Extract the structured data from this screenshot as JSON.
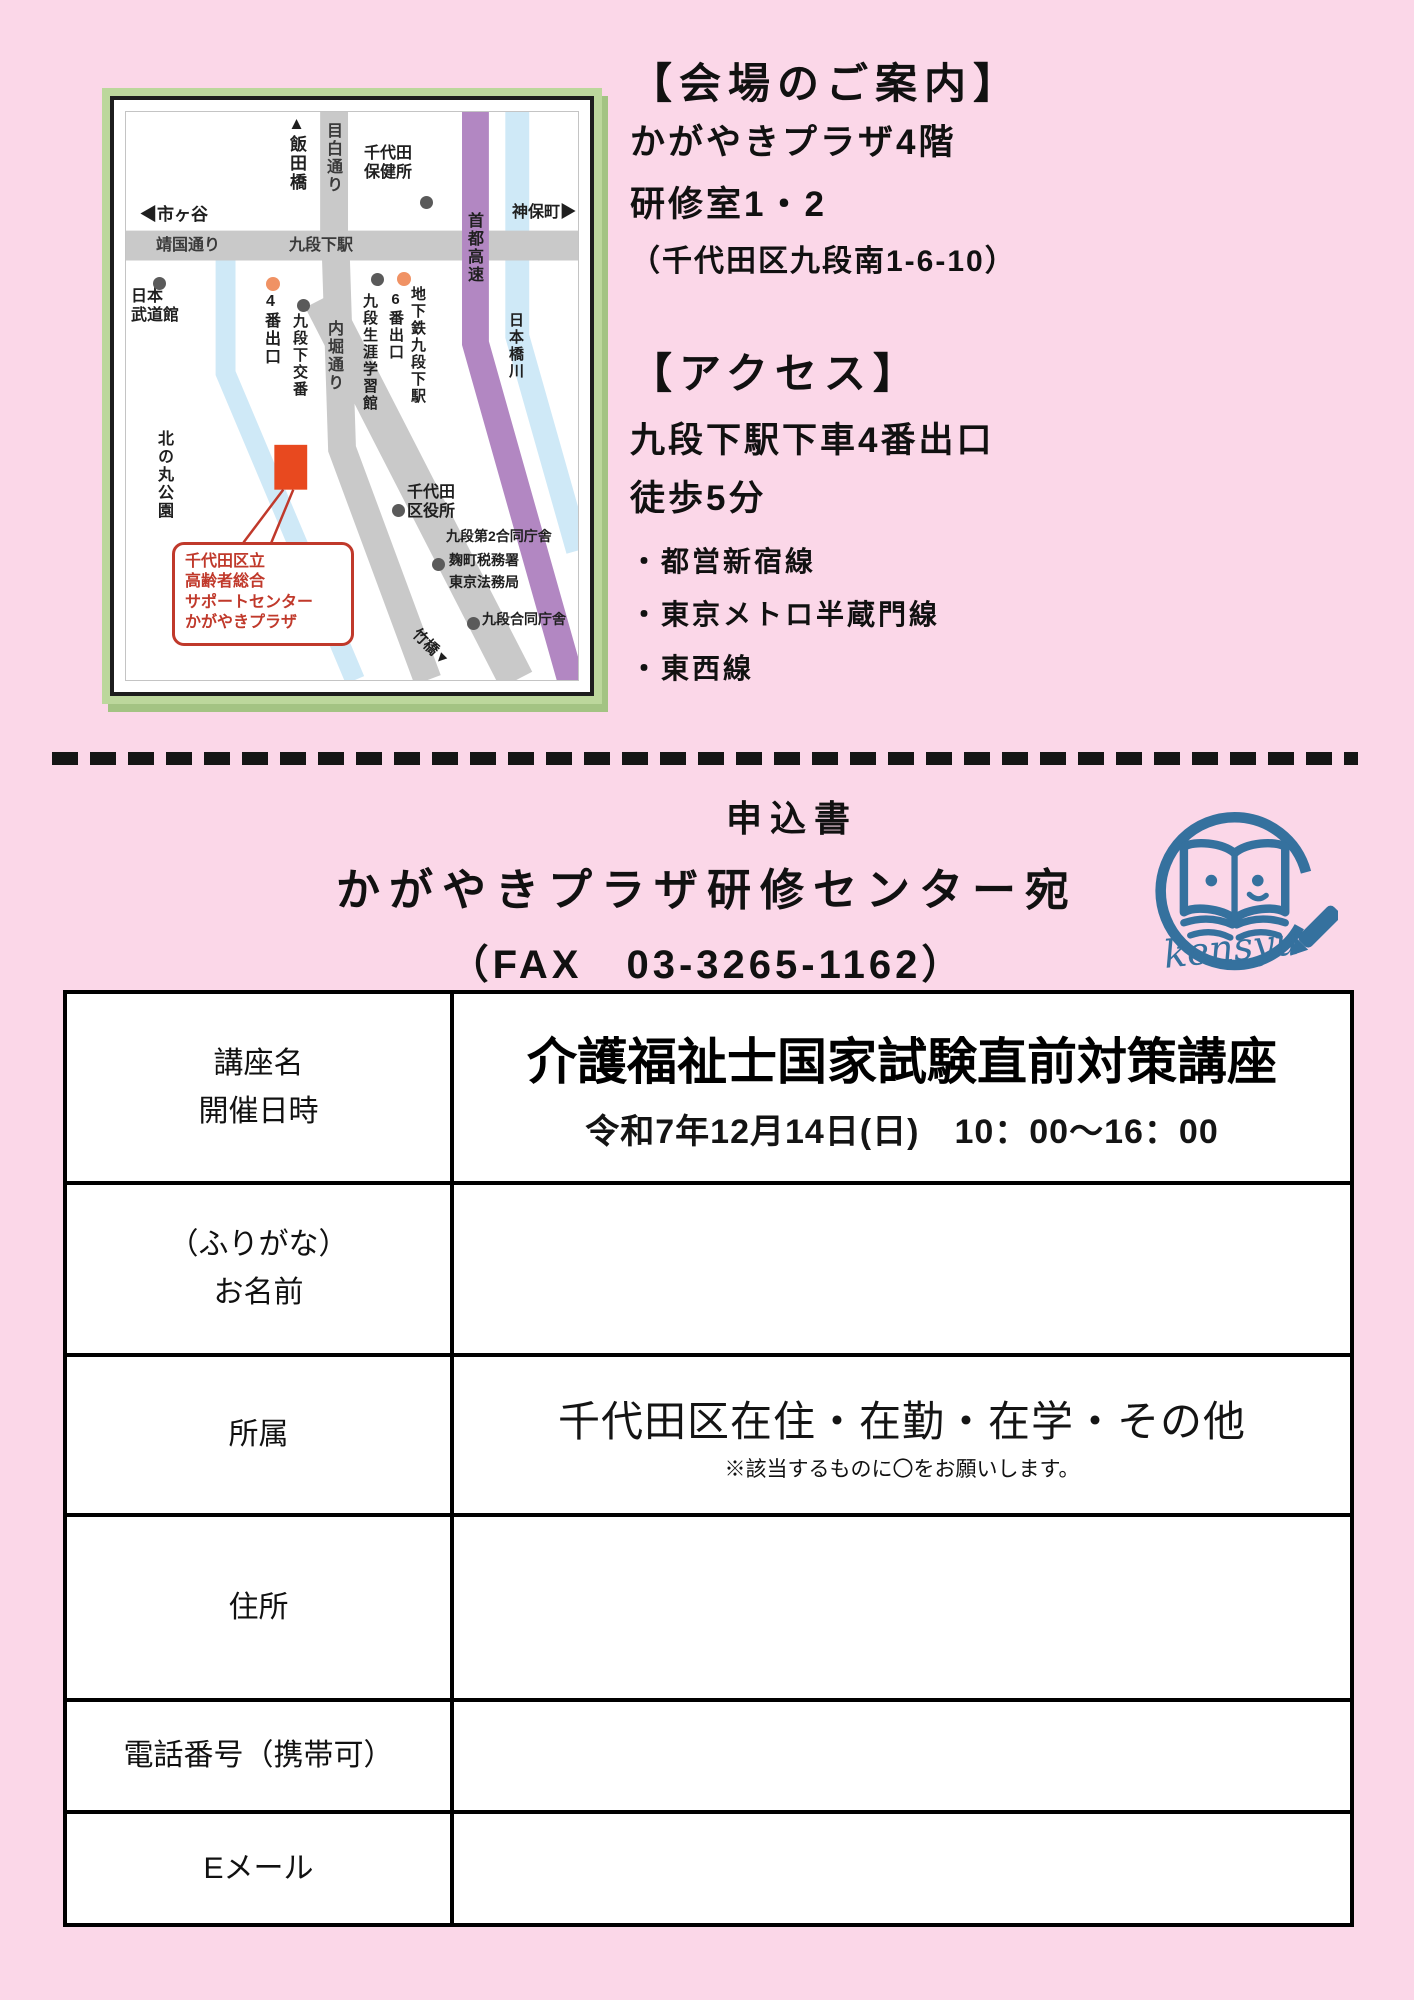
{
  "colors": {
    "page_bg": "#fbd7e8",
    "map_frame_green": "#bcd79c",
    "road_gray": "#c9c9c9",
    "expressway_purple": "#b287c2",
    "river_blue": "#cfe9f7",
    "venue_marker_orange": "#e8491f",
    "callout_red": "#c0392b",
    "exit_dot_orange": "#f09264",
    "logo_blue": "#35719e"
  },
  "map": {
    "iidabashi": "▲飯田橋",
    "mejiro_dori": "目白通り",
    "chiyoda_hokenjo": "千代田\n保健所",
    "ichigaya": "◀市ヶ谷",
    "yasukuni_dori": "靖国通り",
    "kudanshita_station": "九段下駅",
    "jimbocho": "神保町▶",
    "shuto_kosoku": "首都高速",
    "nihonbashi_gawa": "日本橋川",
    "nihon_budokan": "日本\n武道館",
    "exit4": "4番出口",
    "kudanshita_koban": "九段下交番",
    "uchibori_dori": "内堀通り",
    "kudan_shogai_gakushukan": "九段生涯学習館",
    "exit6": "6番出口",
    "chikatetsu_kudanshita": "地下鉄九段下駅",
    "kitanomaru_koen": "北の丸公園",
    "chiyoda_kuyakusho": "千代田\n区役所",
    "kudan_dai2_godochosha": "九段第2合同庁舎",
    "kojimachi_zeimusho": "麹町税務署",
    "tokyo_homukyoku": "東京法務局",
    "kudan_godochosha": "九段合同庁舎",
    "takebashi": "竹橋▼",
    "venue_callout": "千代田区立\n高齢者総合\nサポートセンター\nかがやきプラザ"
  },
  "venue": {
    "heading": "【会場のご案内】",
    "line1": "かがやきプラザ4階",
    "line2": "研修室1・2",
    "address": "（千代田区九段南1-6-10）"
  },
  "access": {
    "heading": "【アクセス】",
    "line1": "九段下駅下車4番出口",
    "line2": "徒歩5分",
    "bullets": [
      "・都営新宿線",
      "・東京メトロ半蔵門線",
      "・東西線"
    ]
  },
  "form_header": {
    "title": "申込書",
    "recipient": "かがやきプラザ研修センター宛",
    "fax_line": "（FAX　03-3265-1162）",
    "logo_text": "kensyu"
  },
  "table": {
    "rows": [
      {
        "label": "講座名\n開催日時",
        "title": "介護福祉士国家試験直前対策講座",
        "subtitle": "令和7年12月14日(日)　10：00～16：00"
      },
      {
        "label": "（ふりがな）\nお名前",
        "value": ""
      },
      {
        "label": "所属",
        "value": "千代田区在住・在勤・在学・その他",
        "note": "※該当するものに〇をお願いします。"
      },
      {
        "label": "住所",
        "value": ""
      },
      {
        "label": "電話番号（携帯可）",
        "value": ""
      },
      {
        "label": "Eメール",
        "value": ""
      }
    ]
  }
}
